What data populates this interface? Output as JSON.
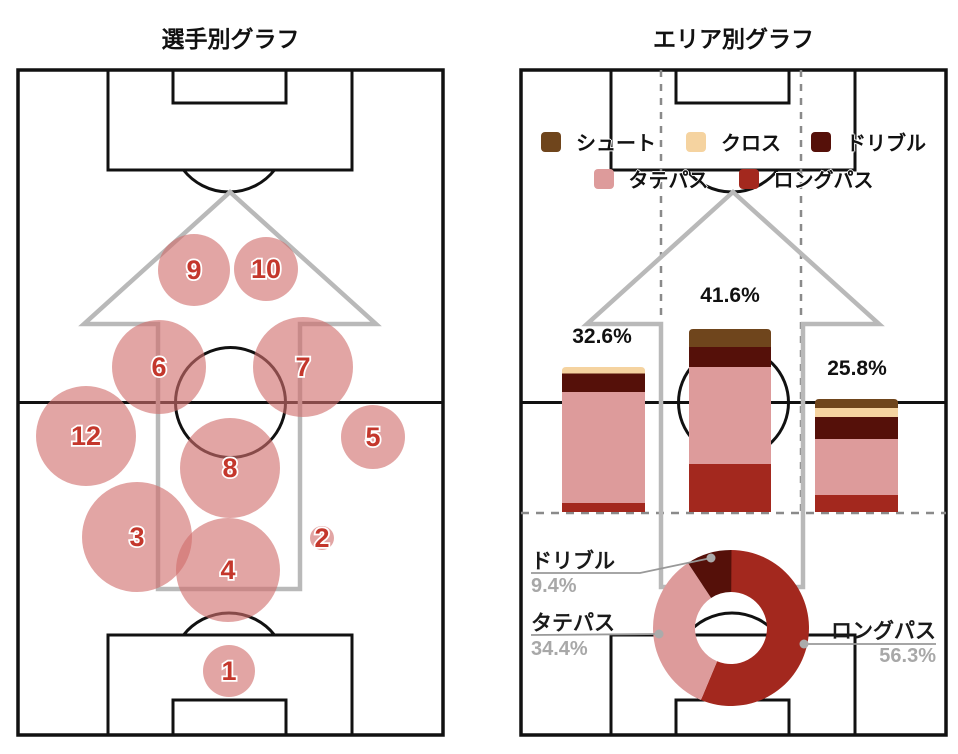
{
  "panels": {
    "left": {
      "title": "選手別グラフ"
    },
    "right": {
      "title": "エリア別グラフ"
    }
  },
  "palette": {
    "shoot": "#6F451C",
    "cross": "#F5D3A0",
    "dribble": "#551009",
    "tate": "#DD9B9B",
    "long": "#A3281E",
    "pitch_line": "#111111",
    "arrow": "#B9B9B9",
    "dashed": "#8A8A8A",
    "bubble_fill": "rgba(209,110,108,0.62)",
    "bubble_number": "#C4372C",
    "pct_gray": "#A8A8A8",
    "label_black": "#1A1A1A",
    "leader": "#999999",
    "leader_dot": "#ABABAB"
  },
  "legend": {
    "rows": [
      [
        {
          "key": "shoot",
          "label": "シュート"
        },
        {
          "key": "cross",
          "label": "クロス"
        },
        {
          "key": "dribble",
          "label": "ドリブル"
        }
      ],
      [
        {
          "key": "tate",
          "label": "タテパス"
        },
        {
          "key": "long",
          "label": "ロングパス"
        }
      ]
    ]
  },
  "chart_data": [
    {
      "type": "bubble",
      "title": "選手別グラフ",
      "note": "player activity bubbles positioned on a vertical soccer pitch, radius = activity volume, px coords",
      "points": [
        {
          "player": "1",
          "x": 229,
          "y": 671,
          "r": 26
        },
        {
          "player": "2",
          "x": 322,
          "y": 538,
          "r": 12
        },
        {
          "player": "3",
          "x": 137,
          "y": 537,
          "r": 55
        },
        {
          "player": "4",
          "x": 228,
          "y": 570,
          "r": 52
        },
        {
          "player": "5",
          "x": 373,
          "y": 437,
          "r": 32
        },
        {
          "player": "6",
          "x": 159,
          "y": 367,
          "r": 47
        },
        {
          "player": "7",
          "x": 303,
          "y": 367,
          "r": 50
        },
        {
          "player": "8",
          "x": 230,
          "y": 468,
          "r": 50
        },
        {
          "player": "9",
          "x": 194,
          "y": 270,
          "r": 36
        },
        {
          "player": "10",
          "x": 266,
          "y": 269,
          "r": 32
        },
        {
          "player": "12",
          "x": 86,
          "y": 436,
          "r": 50
        }
      ]
    },
    {
      "type": "bar",
      "stacked": true,
      "title": "エリア別グラフ",
      "note": "stacked bars per pitch lane; segment heights in px as drawn, totals labeled above bars",
      "bars": [
        {
          "area": "left-lane",
          "total_label": "32.6%",
          "total_pct": 32.6,
          "x": 562,
          "width": 83,
          "bottom": 512,
          "label_x": 602,
          "label_y": 337,
          "segments": [
            {
              "key": "long",
              "h": 9
            },
            {
              "key": "tate",
              "h": 111
            },
            {
              "key": "dribble",
              "h": 18.5
            },
            {
              "key": "cross",
              "h": 6.5
            }
          ]
        },
        {
          "area": "center-lane",
          "total_label": "41.6%",
          "total_pct": 41.6,
          "x": 689,
          "width": 82,
          "bottom": 512,
          "label_x": 730,
          "label_y": 296,
          "segments": [
            {
              "key": "long",
              "h": 48
            },
            {
              "key": "tate",
              "h": 97
            },
            {
              "key": "dribble",
              "h": 20
            },
            {
              "key": "shoot",
              "h": 18
            }
          ]
        },
        {
          "area": "right-lane",
          "total_label": "25.8%",
          "total_pct": 25.8,
          "x": 815,
          "width": 83,
          "bottom": 512,
          "label_x": 857,
          "label_y": 369,
          "segments": [
            {
              "key": "long",
              "h": 17
            },
            {
              "key": "tate",
              "h": 56
            },
            {
              "key": "dribble",
              "h": 22
            },
            {
              "key": "cross",
              "h": 9
            },
            {
              "key": "shoot",
              "h": 9
            }
          ]
        }
      ]
    },
    {
      "type": "pie",
      "donut": true,
      "cx": 731,
      "cy": 628,
      "r_outer": 78,
      "r_inner": 36,
      "start_angle_deg": 0,
      "direction": "clockwise",
      "slices": [
        {
          "key": "long",
          "label": "ロングパス",
          "pct": 56.3,
          "pct_label": "56.3%"
        },
        {
          "key": "tate",
          "label": "タテパス",
          "pct": 34.4,
          "pct_label": "34.4%"
        },
        {
          "key": "dribble",
          "label": "ドリブル",
          "pct": 9.4,
          "pct_label": "9.4%"
        }
      ],
      "leaders": {
        "dribble": {
          "points": [
            [
              531,
              573
            ],
            [
              640,
              573
            ],
            [
              711,
              558
            ]
          ],
          "dot": [
            711,
            558
          ]
        },
        "tate": {
          "points": [
            [
              531,
              635
            ],
            [
              659,
              634
            ]
          ],
          "dot": [
            659,
            634
          ]
        },
        "long": {
          "points": [
            [
              936,
              644
            ],
            [
              804,
              644
            ]
          ],
          "dot": [
            804,
            644
          ]
        }
      }
    }
  ]
}
